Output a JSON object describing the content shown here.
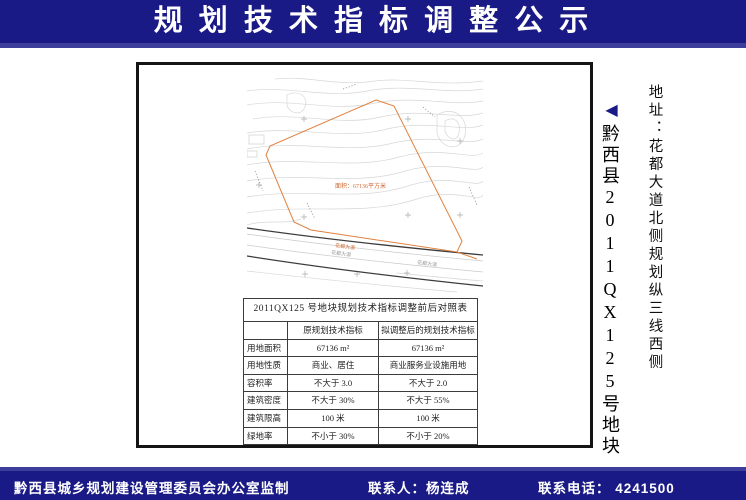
{
  "header": {
    "title": "规 划 技 术 指 标 调 整 公 示"
  },
  "side": {
    "marker": "◀",
    "parcel_title": "黔西县2011QX125号地块",
    "address": "地址：花都大道北侧规划纵三线西侧"
  },
  "map": {
    "parcel_label": "面积：67136平方米",
    "road_label_orange": "花都大道",
    "road_label_gray1": "花都大道",
    "road_label_gray2": "花都大道"
  },
  "table": {
    "title": "2011QX125 号地块规划技术指标调整前后对照表",
    "columns": [
      "",
      "原规划技术指标",
      "拟调整后的规划技术指标"
    ],
    "rows": [
      {
        "label": "用地面积",
        "before": "67136 m²",
        "after": "67136 m²"
      },
      {
        "label": "用地性质",
        "before": "商业、居住",
        "after": "商业服务业设施用地"
      },
      {
        "label": "容积率",
        "before": "不大于 3.0",
        "after": "不大于 2.0"
      },
      {
        "label": "建筑密度",
        "before": "不大于 30%",
        "after": "不大于 55%"
      },
      {
        "label": "建筑限高",
        "before": "100 米",
        "after": "100 米"
      },
      {
        "label": "绿地率",
        "before": "不小于 30%",
        "after": "不小于 20%"
      }
    ]
  },
  "footer": {
    "producer": "黔西县城乡规划建设管理委员会办公室监制",
    "contact": "联系人：杨连成",
    "phone": "联系电话： 4241500"
  },
  "colors": {
    "navy": "#1a1a86",
    "navy_light": "#3d3d9c",
    "parcel_orange": "#d8733a",
    "contour_gray": "#d7d7d7"
  }
}
